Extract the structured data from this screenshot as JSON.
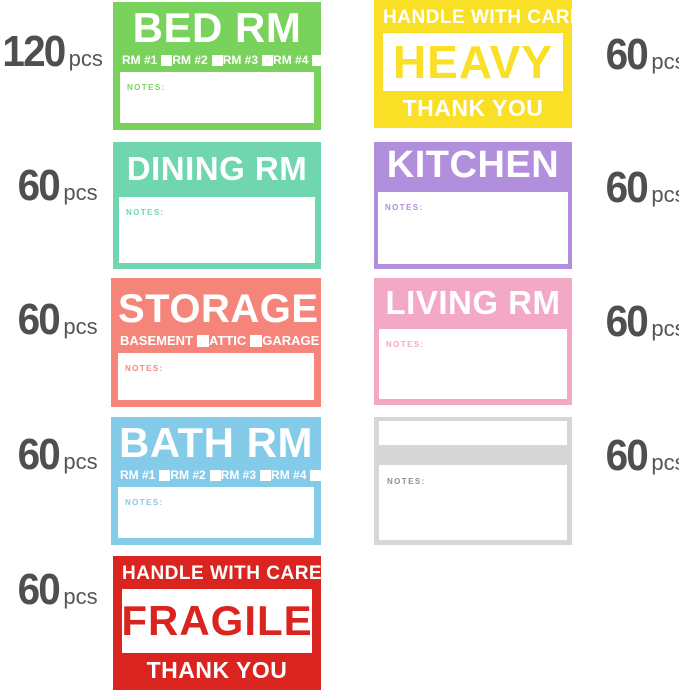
{
  "ui": {
    "quantity_color": "#4f4f4f"
  },
  "quantities": {
    "left": [
      {
        "count": "120",
        "unit": "pcs"
      },
      {
        "count": "60",
        "unit": "pcs"
      },
      {
        "count": "60",
        "unit": "pcs"
      },
      {
        "count": "60",
        "unit": "pcs"
      },
      {
        "count": "60",
        "unit": "pcs"
      }
    ],
    "right": [
      {
        "count": "60",
        "unit": "pcs"
      },
      {
        "count": "60",
        "unit": "pcs"
      },
      {
        "count": "60",
        "unit": "pcs"
      },
      {
        "count": "60",
        "unit": "pcs"
      }
    ]
  },
  "labels": {
    "bed_rm": {
      "title": "BED RM",
      "color": "#79d25b",
      "checkboxes": [
        "RM #1",
        "RM #2",
        "RM #3",
        "RM #4"
      ],
      "notes_label": "NOTES:"
    },
    "dining_rm": {
      "title": "DINING RM",
      "color": "#6fd6b0",
      "notes_label": "NOTES:"
    },
    "storage": {
      "title": "STORAGE",
      "color": "#f5857b",
      "checkboxes": [
        "BASEMENT",
        "ATTIC",
        "GARAGE"
      ],
      "notes_label": "NOTES:"
    },
    "bath_rm": {
      "title": "BATH RM",
      "color": "#84cbe9",
      "checkboxes": [
        "RM #1",
        "RM #2",
        "RM #3",
        "RM #4"
      ],
      "notes_label": "NOTES:"
    },
    "fragile": {
      "top": "HANDLE WITH CARE",
      "title": "FRAGILE",
      "bottom": "THANK YOU",
      "color": "#da2420"
    },
    "heavy": {
      "top": "HANDLE WITH CARE",
      "title": "HEAVY",
      "bottom": "THANK YOU",
      "color": "#f9df25"
    },
    "kitchen": {
      "title": "KITCHEN",
      "color": "#b18fdc",
      "notes_label": "NOTES:"
    },
    "living_rm": {
      "title": "LIVING RM",
      "color": "#f3a8c5",
      "notes_label": "NOTES:"
    },
    "blank": {
      "title": "",
      "color": "#d7d7d7",
      "notes_label": "NOTES:",
      "notes_text_color": "#8f8f8f"
    }
  }
}
